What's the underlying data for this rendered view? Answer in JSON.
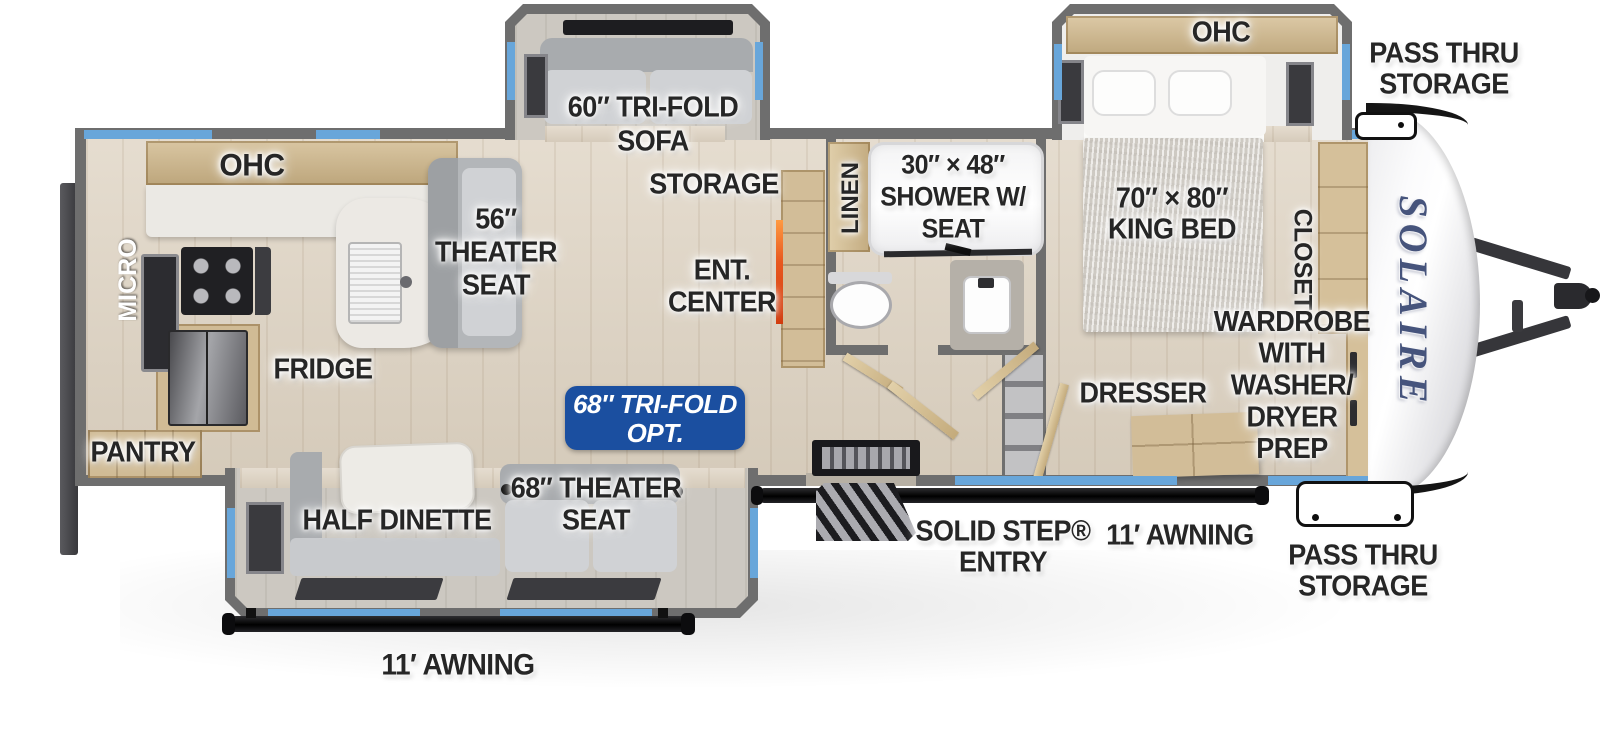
{
  "colors": {
    "badge_blue": "#1b4fa0",
    "window_blue": "#68a6da",
    "wall_gray": "#6e6e6e",
    "fireplace_orange": "#e8581f",
    "logo_blue": "#46547c",
    "label_ink": "#262626"
  },
  "logo": "SOLAIRE",
  "exterior": {
    "pass_thru_top": [
      "PASS THRU",
      "STORAGE"
    ],
    "pass_thru_bottom": [
      "PASS THRU",
      "STORAGE"
    ],
    "entry": [
      "SOLID STEP®",
      "ENTRY"
    ],
    "awning_door_side": "11′ AWNING",
    "awning_camp_side": "11′ AWNING"
  },
  "kitchen": {
    "ohc": "OHC",
    "micro": "MICRO",
    "fridge": "FRIDGE",
    "pantry": "PANTRY",
    "theater_seat": [
      "56″",
      "THEATER",
      "SEAT"
    ]
  },
  "living": {
    "sofa": [
      "60″ TRI-FOLD",
      "SOFA"
    ],
    "storage": "STORAGE",
    "ent_center": [
      "ENT.",
      "CENTER"
    ],
    "half_dinette": "HALF DINETTE",
    "theater_seat": [
      "68″ THEATER",
      "SEAT"
    ],
    "option_badge": [
      "68″ TRI-FOLD",
      "OPT."
    ]
  },
  "bath": {
    "linen": "LINEN",
    "shower": [
      "30″ × 48″",
      "SHOWER W/",
      "SEAT"
    ]
  },
  "bedroom": {
    "ohc": "OHC",
    "bed": [
      "70″ × 80″",
      "KING BED"
    ],
    "closet": "CLOSET",
    "dresser": "DRESSER",
    "wardrobe": [
      "WARDROBE",
      "WITH",
      "WASHER/",
      "DRYER",
      "PREP"
    ]
  }
}
